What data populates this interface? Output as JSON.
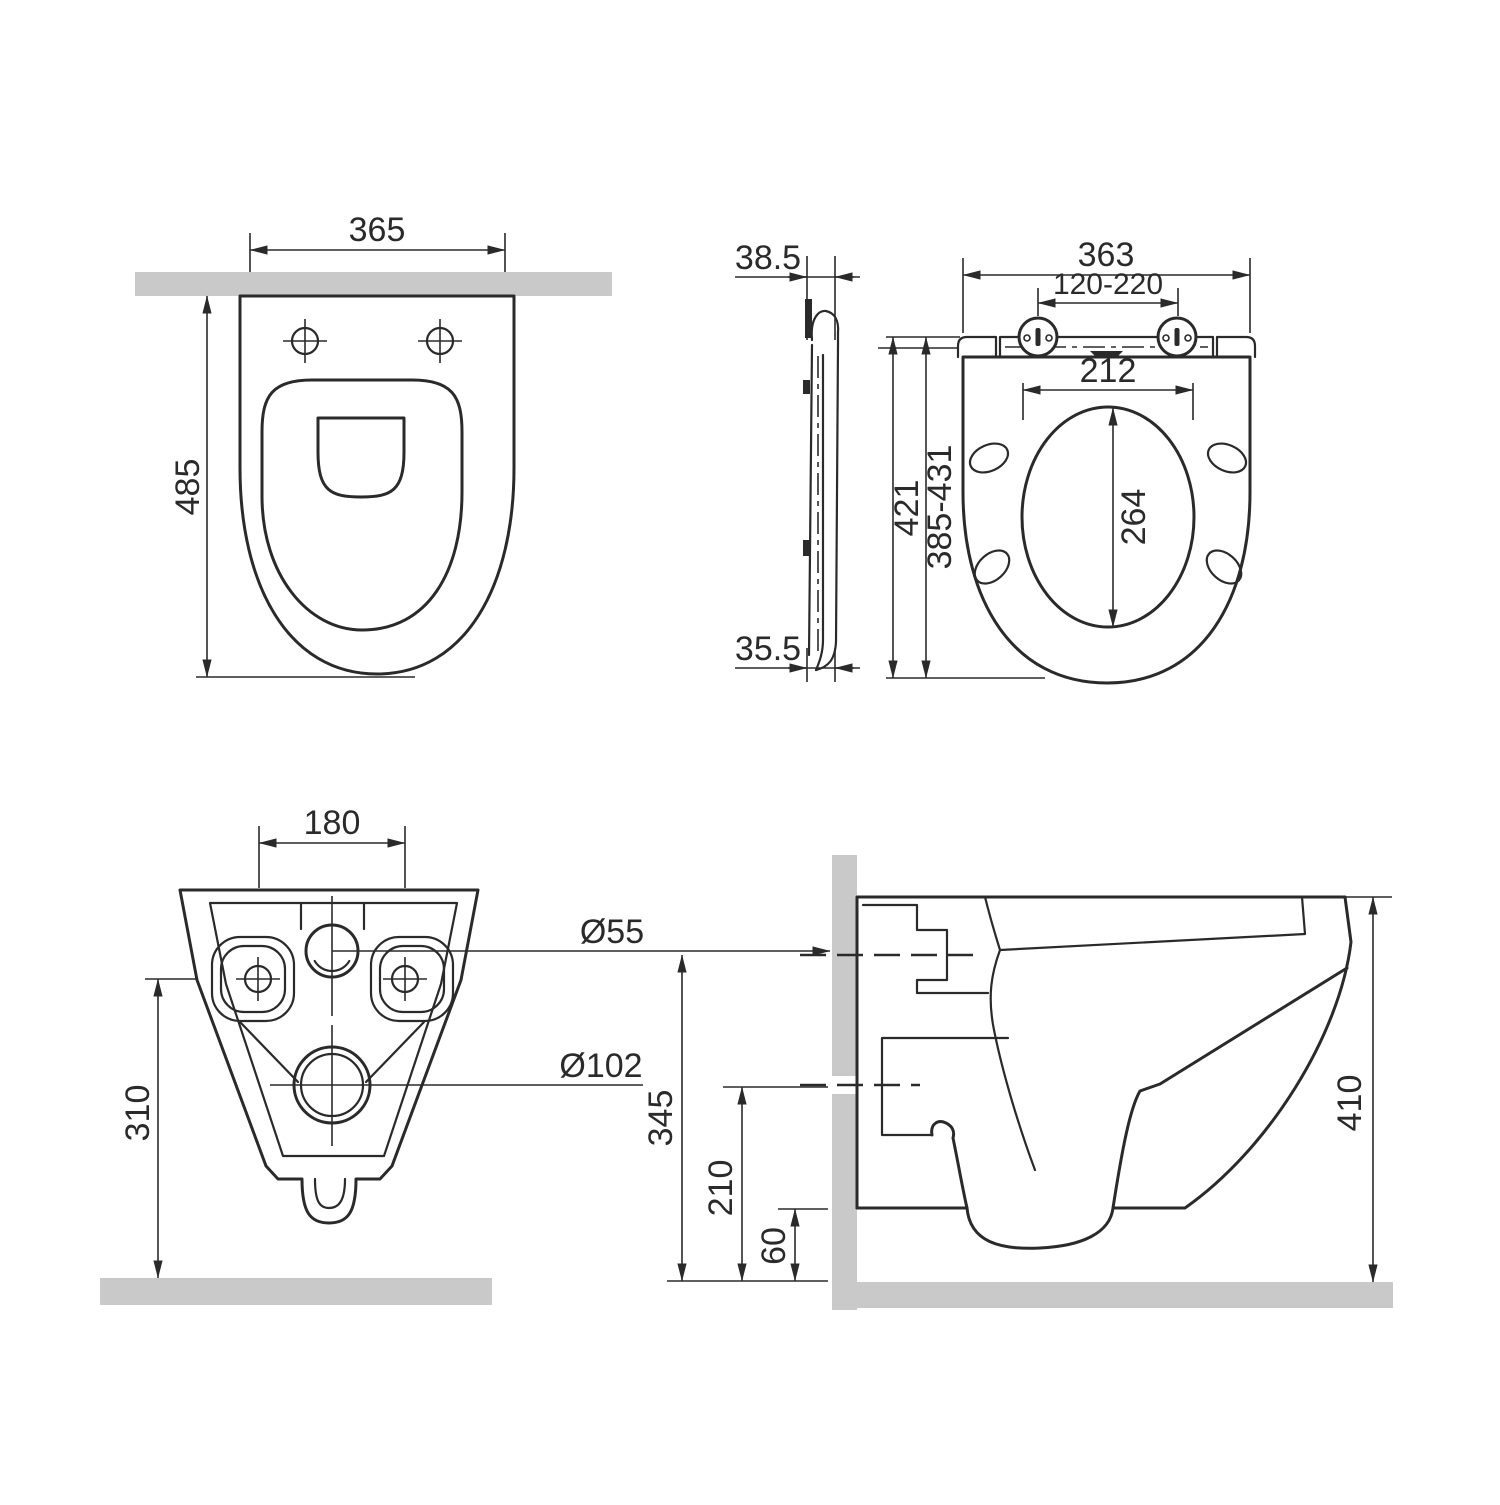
{
  "title": "Wall-hung toilet and seat installation dimensions drawing",
  "colors": {
    "line": "#2a2a2a",
    "surface": "#c9c9ca",
    "bg": "#ffffff"
  },
  "units_note": "",
  "views": {
    "bowl_top": {
      "label": "bowl-top-view",
      "dims": {
        "overall_width": "365",
        "overall_depth": "485"
      }
    },
    "seat_profile": {
      "label": "seat-side-profile-view",
      "dims": {
        "top_thickness": "38.5",
        "bottom_thickness": "35.5"
      }
    },
    "seat_top": {
      "label": "seat-top-view",
      "dims": {
        "overall_width": "363",
        "hinge_span": "120-220",
        "opening_width": "212",
        "opening_depth": "264",
        "overall_length": "421",
        "adjustable_length": "385-431"
      }
    },
    "bowl_back": {
      "label": "bowl-back-view",
      "dims": {
        "fixing_centres": "180",
        "inlet_dia": "Ø55",
        "outlet_dia": "Ø102",
        "height_above_floor": "310"
      }
    },
    "bowl_side": {
      "label": "bowl-side-section-view",
      "dims": {
        "inlet_axis_height": "345",
        "outlet_axis_height": "210",
        "underside_clearance": "60",
        "overall_height": "410"
      }
    }
  }
}
